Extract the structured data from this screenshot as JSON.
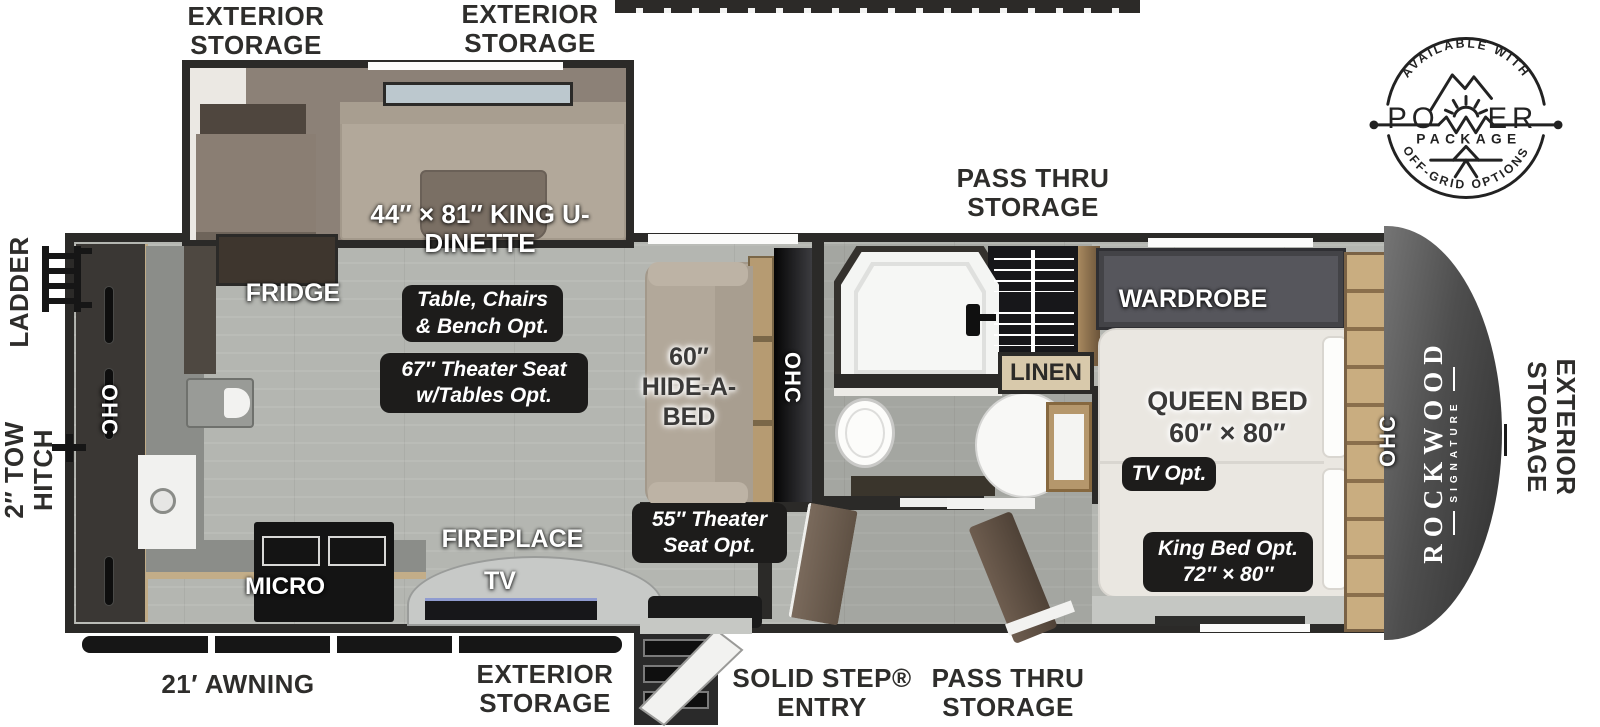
{
  "colors": {
    "wall": "#2b2a28",
    "floor": "#b4b6b1",
    "slide_interior": "#8c8177",
    "bench_tan": "#b2a89a",
    "wood": "#c4a87c",
    "label_box": "#1d1c1b",
    "front_cap": "#4a4a4a",
    "text_dark": "#2e2d2b"
  },
  "top": {
    "exterior_storage_left": "EXTERIOR STORAGE",
    "exterior_storage_right": "EXTERIOR STORAGE",
    "pass_thru": "PASS THRU STORAGE"
  },
  "badge": {
    "available_with": "AVAILABLE WITH",
    "power_left": "PO",
    "power_right": "ER",
    "package": "PACKAGE",
    "off_grid": "OFF-GRID OPTIONS"
  },
  "left": {
    "ladder": "LADDER",
    "tow_hitch": "2″ TOW HITCH"
  },
  "right": {
    "exterior_storage": "EXTERIOR STORAGE"
  },
  "bottom": {
    "awning": "21′ AWNING",
    "exterior_storage": "EXTERIOR STORAGE",
    "solid_step": "SOLID STEP® ENTRY",
    "pass_thru": "PASS THRU STORAGE"
  },
  "interior": {
    "dinette": "44″ × 81″ KING U-DINETTE",
    "fridge": "FRIDGE",
    "table_opt": "Table, Chairs & Bench Opt.",
    "theater67": "67″ Theater Seat w/Tables Opt.",
    "hide_a_bed": "60″ HIDE-A-BED",
    "ohc": "OHC",
    "micro": "MICRO",
    "fireplace": "FIREPLACE",
    "tv": "TV",
    "theater55": "55″ Theater Seat Opt.",
    "wardrobe": "WARDROBE",
    "linen": "LINEN",
    "queen_bed": "QUEEN BED 60″ × 80″",
    "tv_opt": "TV Opt.",
    "king_opt": "King Bed Opt. 72″ × 80″",
    "brand": "ROCKWOOD",
    "brand_sub": "SIGNATURE"
  }
}
